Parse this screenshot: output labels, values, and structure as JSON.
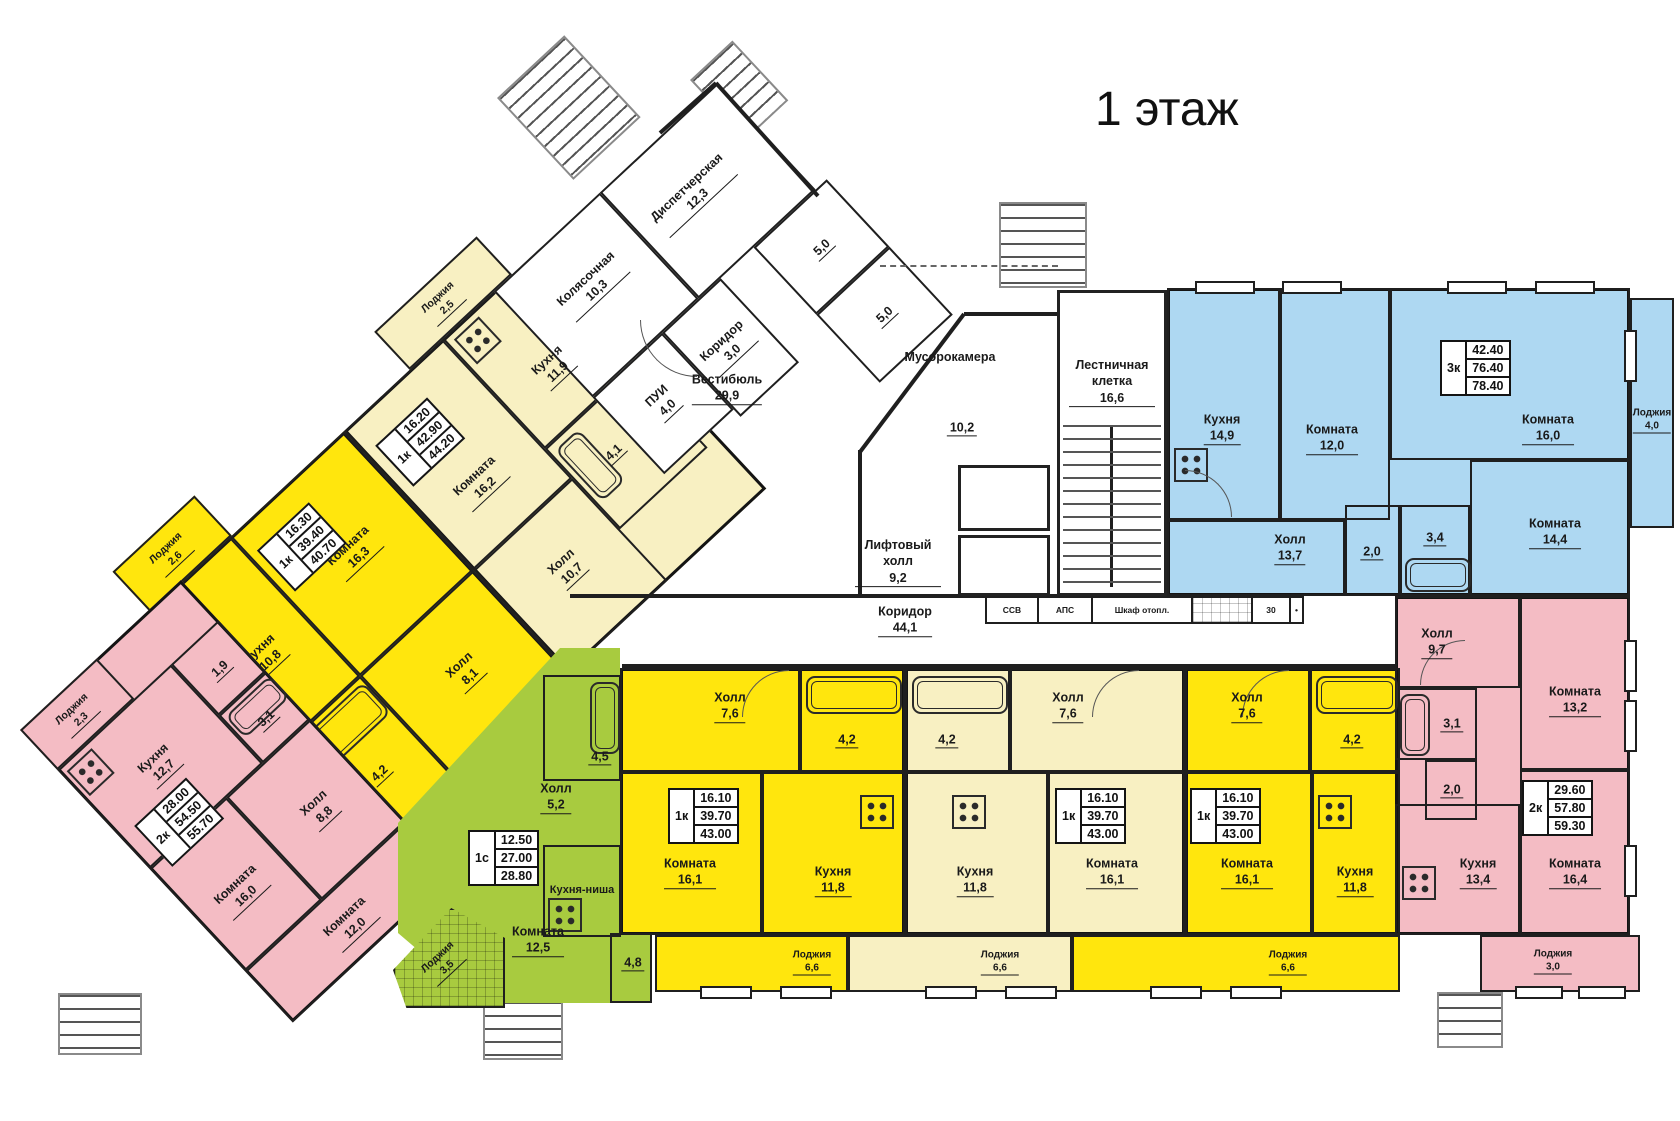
{
  "title": "1 этаж",
  "colors": {
    "yellow": "#FFE60D",
    "cream": "#F8F0C2",
    "pink": "#F4BCC4",
    "blue": "#AED8F2",
    "green": "#A8CB3F",
    "wall": "#1F1F1F"
  },
  "specs": {
    "ca": {
      "type": "1к",
      "v1": "16.20",
      "v2": "42.90",
      "v3": "44.20"
    },
    "ya": {
      "type": "1к",
      "v1": "16.30",
      "v2": "39.40",
      "v3": "40.70"
    },
    "pl": {
      "type": "2к",
      "v1": "28.00",
      "v2": "54.50",
      "v3": "55.70"
    },
    "g": {
      "type": "1с",
      "v1": "12.50",
      "v2": "27.00",
      "v3": "28.80"
    },
    "yb": {
      "type": "1к",
      "v1": "16.10",
      "v2": "39.70",
      "v3": "43.00"
    },
    "cb": {
      "type": "1к",
      "v1": "16.10",
      "v2": "39.70",
      "v3": "43.00"
    },
    "yc": {
      "type": "1к",
      "v1": "16.10",
      "v2": "39.70",
      "v3": "43.00"
    },
    "b": {
      "type": "3к",
      "v1": "42.40",
      "v2": "76.40",
      "v3": "78.40"
    },
    "pr": {
      "type": "2к",
      "v1": "29.60",
      "v2": "57.80",
      "v3": "59.30"
    }
  },
  "rooms": {
    "ya_room": {
      "name": "Комната",
      "area": "16,3"
    },
    "ya_kitchen": {
      "name": "Кухня",
      "area": "10,8"
    },
    "ya_hall": {
      "name": "Холл",
      "area": "8,1"
    },
    "ya_bath": {
      "name": "",
      "area": "4,2"
    },
    "ya_loggia": {
      "name": "Лоджия",
      "area": "2,6"
    },
    "ca_room": {
      "name": "Комната",
      "area": "16,2"
    },
    "ca_kitchen": {
      "name": "Кухня",
      "area": "11,9"
    },
    "ca_hall": {
      "name": "Холл",
      "area": "10,7"
    },
    "ca_bath": {
      "name": "",
      "area": "4,1"
    },
    "ca_loggia": {
      "name": "Лоджия",
      "area": "2,5"
    },
    "pl_loggia": {
      "name": "Лоджия",
      "area": "2,3"
    },
    "pl_kitchen": {
      "name": "Кухня",
      "area": "12,7"
    },
    "pl_wc": {
      "name": "",
      "area": "1,9"
    },
    "pl_bath": {
      "name": "",
      "area": "3,1"
    },
    "pl_hall": {
      "name": "Холл",
      "area": "8,8"
    },
    "pl_room16": {
      "name": "Комната",
      "area": "16,0"
    },
    "pl_room12": {
      "name": "Комната",
      "area": "12,0"
    },
    "g_bath": {
      "name": "",
      "area": "4,5"
    },
    "g_hall": {
      "name": "Холл",
      "area": "5,2"
    },
    "g_niche": {
      "name": "Кухня-ниша",
      "area": ""
    },
    "g_room": {
      "name": "Комната",
      "area": "12,5"
    },
    "g_48": {
      "name": "",
      "area": "4,8"
    },
    "g_loggia": {
      "name": "Лоджия",
      "area": "3,5"
    },
    "yb_hall": {
      "name": "Холл",
      "area": "7,6"
    },
    "yb_bath": {
      "name": "",
      "area": "4,2"
    },
    "yb_room": {
      "name": "Комната",
      "area": "16,1"
    },
    "yb_kitchen": {
      "name": "Кухня",
      "area": "11,8"
    },
    "yb_loggia": {
      "name": "Лоджия",
      "area": "6,6"
    },
    "cb_bath": {
      "name": "",
      "area": "4,2"
    },
    "cb_hall": {
      "name": "Холл",
      "area": "7,6"
    },
    "cb_kitchen": {
      "name": "Кухня",
      "area": "11,8"
    },
    "cb_room": {
      "name": "Комната",
      "area": "16,1"
    },
    "cb_loggia": {
      "name": "Лоджия",
      "area": "6,6"
    },
    "yc_hall": {
      "name": "Холл",
      "area": "7,6"
    },
    "yc_bath": {
      "name": "",
      "area": "4,2"
    },
    "yc_room": {
      "name": "Комната",
      "area": "16,1"
    },
    "yc_kitchen": {
      "name": "Кухня",
      "area": "11,8"
    },
    "yc_loggia": {
      "name": "Лоджия",
      "area": "6,6"
    },
    "b_kitchen": {
      "name": "Кухня",
      "area": "14,9"
    },
    "b_room12": {
      "name": "Комната",
      "area": "12,0"
    },
    "b_room16": {
      "name": "Комната",
      "area": "16,0"
    },
    "b_room14": {
      "name": "Комната",
      "area": "14,4"
    },
    "b_hall": {
      "name": "Холл",
      "area": "13,7"
    },
    "b_20": {
      "name": "",
      "area": "2,0"
    },
    "b_34": {
      "name": "",
      "area": "3,4"
    },
    "b_loggia": {
      "name": "Лоджия",
      "area": "4,0"
    },
    "pr_hall": {
      "name": "Холл",
      "area": "9,7"
    },
    "pr_31": {
      "name": "",
      "area": "3,1"
    },
    "pr_20": {
      "name": "",
      "area": "2,0"
    },
    "pr_kitchen": {
      "name": "Кухня",
      "area": "13,4"
    },
    "pr_room132": {
      "name": "Комната",
      "area": "13,2"
    },
    "pr_room164": {
      "name": "Комната",
      "area": "16,4"
    },
    "pr_loggia": {
      "name": "Лоджия",
      "area": "3,0"
    },
    "kolyas": {
      "name": "Колясочная",
      "area": "10,3"
    },
    "dispatch": {
      "name": "Диспетчерская",
      "area": "12,3"
    },
    "pui": {
      "name": "ПУИ",
      "area": "4,0"
    },
    "kor3": {
      "name": "Коридор",
      "area": "3,0"
    },
    "vest": {
      "name": "Вестибюль",
      "area": "29,9"
    },
    "r50a": {
      "name": "",
      "area": "5,0"
    },
    "r50b": {
      "name": "",
      "area": "5,0"
    },
    "musor": {
      "name": "Мусорокамера",
      "area": "10,2"
    },
    "stairs": {
      "name": "Лестничная клетка",
      "area": "16,6"
    },
    "lift": {
      "name": "Лифтовый холл",
      "area": "9,2"
    },
    "kor44": {
      "name": "Коридор",
      "area": "44,1"
    }
  },
  "tech": {
    "t1": "ССВ",
    "t2": "АПС",
    "t3": "Шкаф отопл.",
    "t4": "30"
  }
}
